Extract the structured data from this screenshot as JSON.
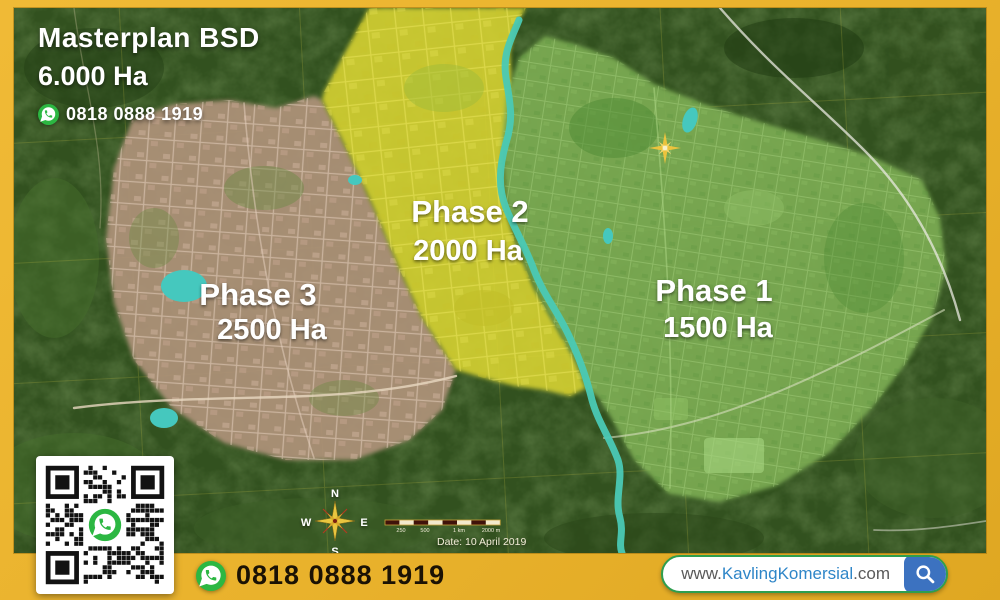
{
  "header": {
    "title": "Masterplan BSD",
    "area": "6.000 Ha",
    "phone": "0818 0888 1919"
  },
  "phases": [
    {
      "name": "Phase 1",
      "area": "1500 Ha",
      "color": "#7CAC52"
    },
    {
      "name": "Phase 2",
      "area": "2000 Ha",
      "color": "#D6D232"
    },
    {
      "name": "Phase 3",
      "area": "2500 Ha",
      "color": "#AE9279"
    }
  ],
  "map": {
    "compass": {
      "n": "N",
      "e": "E",
      "s": "S",
      "w": "W"
    },
    "scale_labels": [
      "250",
      "500",
      "1 km",
      "2000 m"
    ],
    "date": "Date: 10 April 2019"
  },
  "footer": {
    "phone": "0818 0888 1919",
    "website": {
      "prefix": "www.",
      "name": "KavlingKomersial",
      "suffix": ".com"
    }
  },
  "colors": {
    "frame_gold": "#E9B22C",
    "whatsapp_green": "#2CB742",
    "river_teal": "#4AC9B5",
    "search_blue": "#3C72C0",
    "pill_border_green": "#2E9E4F"
  }
}
